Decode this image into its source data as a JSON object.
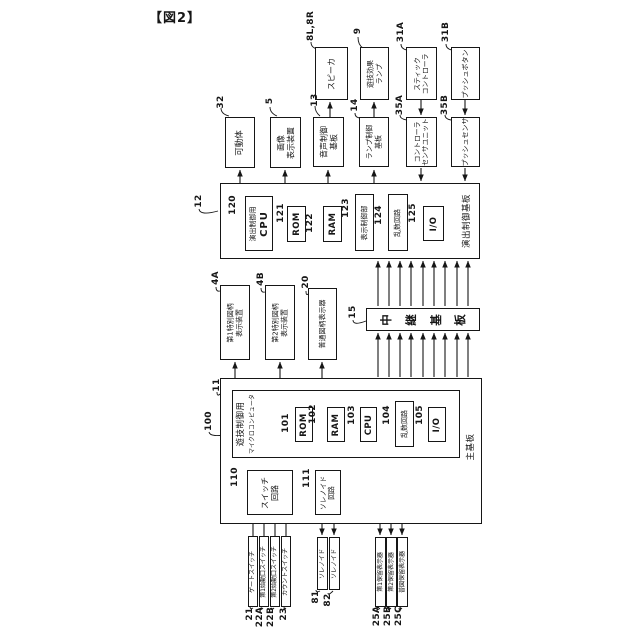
{
  "figure": {
    "title": "【図2】"
  },
  "colors": {
    "line": "#161616",
    "background": "#ffffff"
  },
  "boxes": {
    "speaker": {
      "ref": "8L,8R",
      "label": "スピーカ"
    },
    "effect_lamp": {
      "ref": "9",
      "label": "遊技効果\nランプ"
    },
    "stick_controller": {
      "ref": "31A",
      "label": "スティック\nコントローラ"
    },
    "push_button": {
      "ref": "31B",
      "label": "プッシュボタン"
    },
    "movable_body": {
      "ref": "32",
      "label": "可動体"
    },
    "image_display": {
      "ref": "5",
      "label": "画像\n表示装置"
    },
    "sound_control_board": {
      "ref": "13",
      "label": "音声制御\n基板"
    },
    "lamp_control_board": {
      "ref": "14",
      "label": "ランプ制御\n基板"
    },
    "controller_sensor_unit": {
      "ref": "35A",
      "label": "コントローラ\nセンサユニット"
    },
    "push_sensor": {
      "ref": "35B",
      "label": "プッシュセンサ"
    },
    "effect_control_board": {
      "ref": "12",
      "label": "演出制御基板"
    },
    "effect_cpu": {
      "ref": "120",
      "label_top": "演出制御用",
      "label_sub": "CPU"
    },
    "effect_rom": {
      "ref": "121",
      "label": "ROM"
    },
    "effect_ram": {
      "ref": "122",
      "label": "RAM"
    },
    "display_control": {
      "ref": "123",
      "label": "表示制御部"
    },
    "effect_random": {
      "ref": "124",
      "label": "乱数回路"
    },
    "effect_io": {
      "ref": "125",
      "label": "I/O"
    },
    "special_display_1": {
      "ref": "4A",
      "label": "第1特別図柄\n表示装置"
    },
    "special_display_2": {
      "ref": "4B",
      "label": "第2特別図柄\n表示装置"
    },
    "normal_display": {
      "ref": "20",
      "label": "普通図柄表示器"
    },
    "relay_board": {
      "ref": "15",
      "label": "中継基板"
    },
    "main_board": {
      "ref": "11",
      "label": "主基板"
    },
    "game_micro": {
      "ref": "100",
      "label_top": "遊技制御用",
      "label_sub": "マイクロコンピュータ"
    },
    "main_rom": {
      "ref": "101",
      "label": "ROM"
    },
    "main_ram": {
      "ref": "102",
      "label": "RAM"
    },
    "main_cpu": {
      "ref": "103",
      "label": "CPU"
    },
    "main_random": {
      "ref": "104",
      "label": "乱数回路"
    },
    "main_io": {
      "ref": "105",
      "label": "I/O"
    },
    "switch_circuit": {
      "ref": "110",
      "label": "スイッチ\n回路"
    },
    "solenoid_circuit": {
      "ref": "111",
      "label": "ソレノイド\n回路"
    },
    "gate_switch": {
      "ref": "21",
      "label": "ゲートスイッチ"
    },
    "start_switch_1": {
      "ref": "22A",
      "label": "第1始動口スイッチ"
    },
    "start_switch_2": {
      "ref": "22B",
      "label": "第2始動口スイッチ"
    },
    "count_switch": {
      "ref": "23",
      "label": "カウントスイッチ"
    },
    "solenoid_81": {
      "ref": "81",
      "label": "ソレノイド"
    },
    "solenoid_82": {
      "ref": "82",
      "label": "ソレノイド"
    },
    "hold_display_1": {
      "ref": "25A",
      "label": "第1保留表示器"
    },
    "hold_display_2": {
      "ref": "25B",
      "label": "第2保留表示器"
    },
    "normal_hold_display": {
      "ref": "25C",
      "label": "普図保留表示器"
    }
  }
}
